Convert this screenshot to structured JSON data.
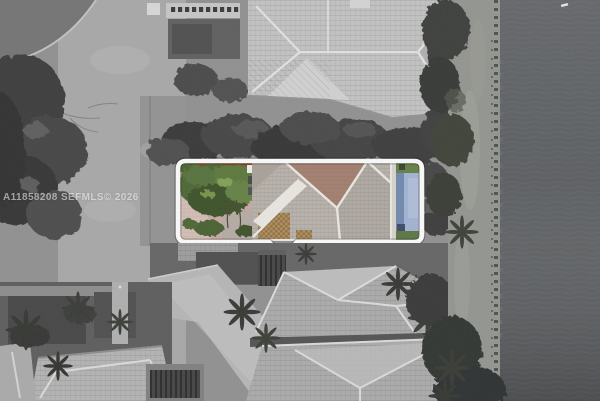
{
  "photo": {
    "watermark_text": "A11858208 SEFMLS© 2026",
    "watermark_color": "#ffffff"
  },
  "colors": {
    "highlight_outline": "#ffffff",
    "ground_gray": "#8c8c8c",
    "road_gray": "#a6a6a6",
    "water_gray": "#505356",
    "tree_gray": "#333333",
    "roof_gray_light": "#c2c2c2",
    "roof_gray_mid": "#a9a9a9",
    "pavers_pink": "#c9a8a3",
    "mulch_brown": "#7d3f1f",
    "foliage_mid": "#547231",
    "roof_tile_gray": "#b6b0a8",
    "roof_plane_mauve": "#a17a69",
    "roof_tan": "#ae8952",
    "roof_ridge_white": "#eceae4",
    "pool_blue": "#9fb2d4",
    "pool_blue_dark": "#6b84ad",
    "pool_step_dark": "#33415e",
    "deck_green": "#5d7a3c"
  }
}
